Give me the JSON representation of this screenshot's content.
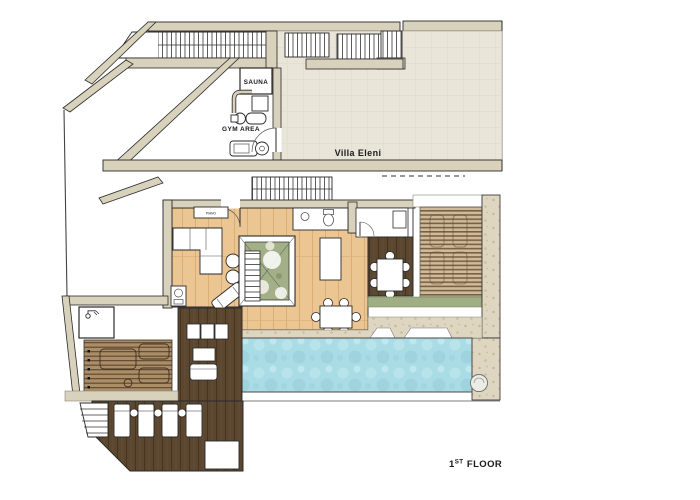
{
  "plan": {
    "title": "Villa Eleni",
    "floor_label": {
      "num": "1",
      "sup": "ST",
      "rest": "FLOOR"
    },
    "labels": {
      "sauna": "SAUNA",
      "gym": "GYM AREA",
      "piano": "PIANO"
    },
    "palette": {
      "wall": "#d8d1bb",
      "tile": "#e9e5d8",
      "wood_light": "#ebc693",
      "wood_dark": "#5b4630",
      "slat_line": "#7d5f41",
      "stone": "#ded6c0",
      "pool": "#aadce5",
      "planting": "#a3b087",
      "line": "#2a2a2a"
    }
  }
}
